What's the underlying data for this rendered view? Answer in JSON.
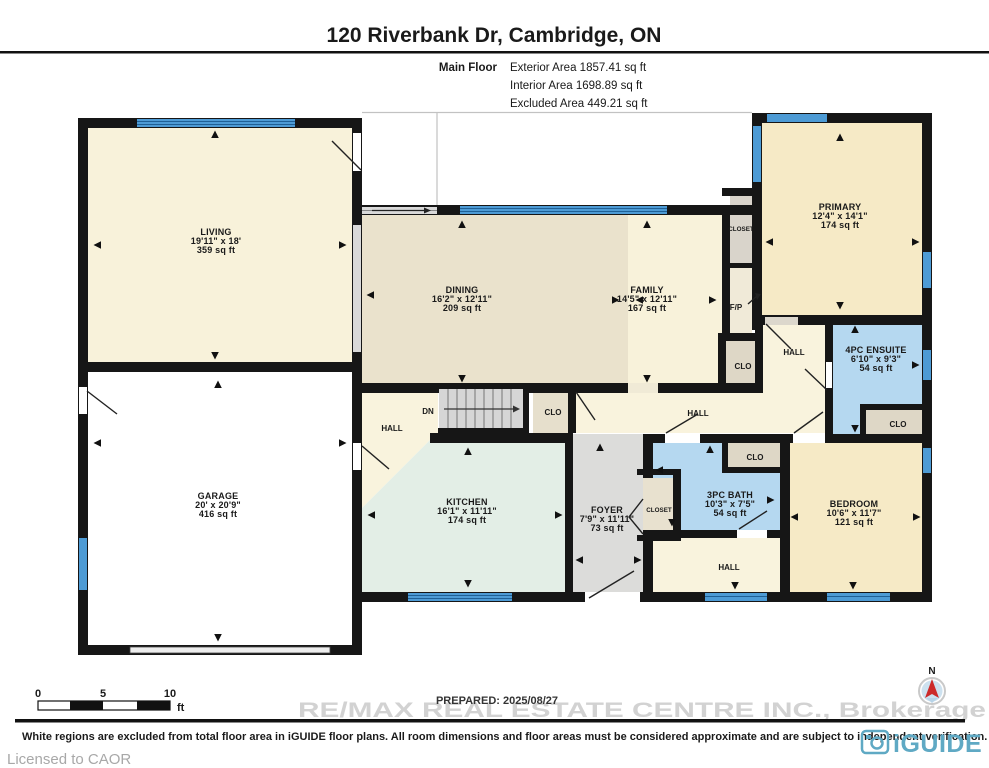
{
  "header": {
    "title": "120 Riverbank Dr, Cambridge, ON",
    "floor_label": "Main Floor",
    "exterior": "Exterior Area 1857.41 sq ft",
    "interior": "Interior Area 1698.89 sq ft",
    "excluded": "Excluded Area 449.21 sq ft"
  },
  "rooms": {
    "living": {
      "name": "LIVING",
      "dims": "19'11\" x 18'",
      "area": "359 sq ft"
    },
    "garage": {
      "name": "GARAGE",
      "dims": "20' x 20'9\"",
      "area": "416 sq ft"
    },
    "dining": {
      "name": "DINING",
      "dims": "16'2\" x 12'11\"",
      "area": "209 sq ft"
    },
    "family": {
      "name": "FAMILY",
      "dims": "14'5\" x 12'11\"",
      "area": "167 sq ft"
    },
    "primary": {
      "name": "PRIMARY",
      "dims": "12'4\" x 14'1\"",
      "area": "174 sq ft"
    },
    "ensuite": {
      "name": "4PC ENSUITE",
      "dims": "6'10\" x 9'3\"",
      "area": "54 sq ft"
    },
    "kitchen": {
      "name": "KITCHEN",
      "dims": "16'1\" x 11'11\"",
      "area": "174 sq ft"
    },
    "foyer": {
      "name": "FOYER",
      "dims": "7'9\" x 11'11\"",
      "area": "73 sq ft"
    },
    "bath": {
      "name": "3PC BATH",
      "dims": "10'3\" x 7'5\"",
      "area": "54 sq ft"
    },
    "bedroom": {
      "name": "BEDROOM",
      "dims": "10'6\" x 11'7\"",
      "area": "121 sq ft"
    }
  },
  "labels": {
    "hall": "HALL",
    "clo": "CLO",
    "closet": "CLOSET",
    "dn": "DN",
    "fp": "F/P",
    "north": "N"
  },
  "scale_bar": {
    "t0": "0",
    "t5": "5",
    "t10": "10",
    "unit": "ft"
  },
  "footer": {
    "prepared": "PREPARED: 2025/08/27",
    "watermark": "RE/MAX REAL ESTATE CENTRE INC., Brokerage",
    "disclaimer": "White regions are excluded from total floor area in iGUIDE floor plans. All room dimensions and floor areas must be considered approximate and are subject to independent verification.",
    "licensed": "Licensed to CAOR",
    "brand": "iGUIDE"
  },
  "colors": {
    "wall": "#161616",
    "window_blue": "#4d9bd5",
    "cream": "#f8f2da",
    "dining_beige": "#eae2cc",
    "bedroom_yellow": "#f6eac6",
    "kitchen_mint": "#e3eee6",
    "bath_blue": "#b5d8f0",
    "foyer_gray": "#dcdcda",
    "closet_beige": "#e4ddc9",
    "brand_teal": "#5fa9c4",
    "compass_red": "#cc2a2a"
  }
}
